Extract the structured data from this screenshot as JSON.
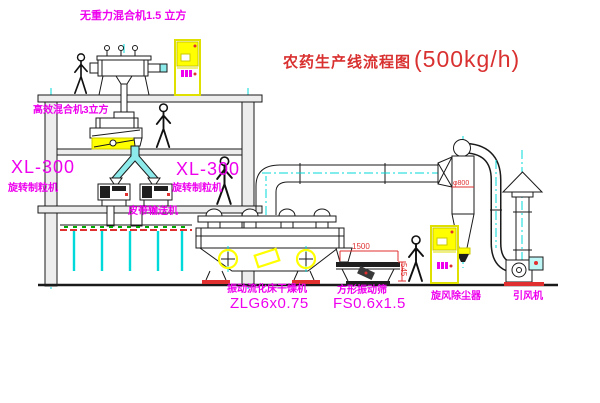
{
  "title": {
    "main": "农药生产线流程图",
    "capacity": "(500kg/h)"
  },
  "labels": {
    "gravity_free_mixer": "无重力混合机1.5 立方",
    "high_efficiency_mixer": "高效混合机3立方",
    "granulator_left_model": "XL-300",
    "granulator_left_name": "旋转制粒机",
    "granulator_right_model": "XL-300",
    "granulator_right_name": "旋转制粒机",
    "belt_conveyor": "皮带输送机",
    "dryer_name": "振动流化床干燥机",
    "dryer_model": "ZLG6x0.75",
    "sieve_name": "方形振动筛",
    "sieve_model": "FS0.6x1.5",
    "cyclone": "旋风除尘器",
    "fan": "引风机"
  },
  "dimensions": {
    "sieve_length": "1500",
    "sieve_height": "545",
    "cyclone_dia": "φ800"
  },
  "colors": {
    "line": "#1a1a1a",
    "label": "#ee00ee",
    "title": "#d93030",
    "dimension": "#e03030",
    "conveyor": "#e03030",
    "centerline": "#00d9d9",
    "highlight": "#ffff00",
    "hatch_green": "#00a800"
  }
}
